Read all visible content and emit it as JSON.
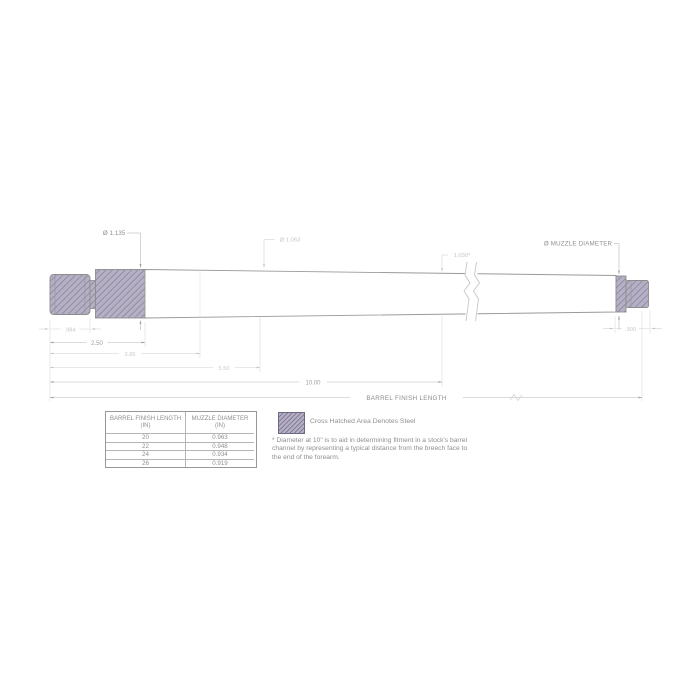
{
  "drawing": {
    "dims": {
      "shank_diameter": "Ø 1.135",
      "mid_diameter": "Ø 1.063",
      "diameter_at_10": "1.030*",
      "muzzle_diameter_label": "Ø MUZZLE DIAMETER",
      "tenon_length": ".984",
      "shank_length": "2.50",
      "taper_length": "3.86",
      "mid_length": "5.50",
      "channel_length": "10.00",
      "muzzle_cap_length": ".900",
      "finish_length_label": "BARREL FINISH LENGTH"
    }
  },
  "table": {
    "columns": [
      {
        "title": "BARREL FINISH LENGTH",
        "unit": "(IN)"
      },
      {
        "title": "MUZZLE DIAMETER",
        "unit": "(IN)"
      }
    ],
    "rows": [
      {
        "length": "20",
        "diameter": "0.963"
      },
      {
        "length": "22",
        "diameter": "0.948"
      },
      {
        "length": "24",
        "diameter": "0.934"
      },
      {
        "length": "26",
        "diameter": "0.919"
      }
    ]
  },
  "legend": {
    "label": "Cross Hatched Area Denotes Steel"
  },
  "footnote": "* Diameter at 10\" is to aid in determining fitment in a stock's barrel channel by representing a typical distance from the breech face to the end of the forearm.",
  "colors": {
    "steel_fill": "#b6b0c4",
    "steel_hatch": "#847d99",
    "outline": "#9a9a9a",
    "dim_line": "#b8b8b8",
    "dim_text_dark": "#8f8f8f",
    "dim_text_faint": "#c6c6c6",
    "background": "#ffffff"
  }
}
